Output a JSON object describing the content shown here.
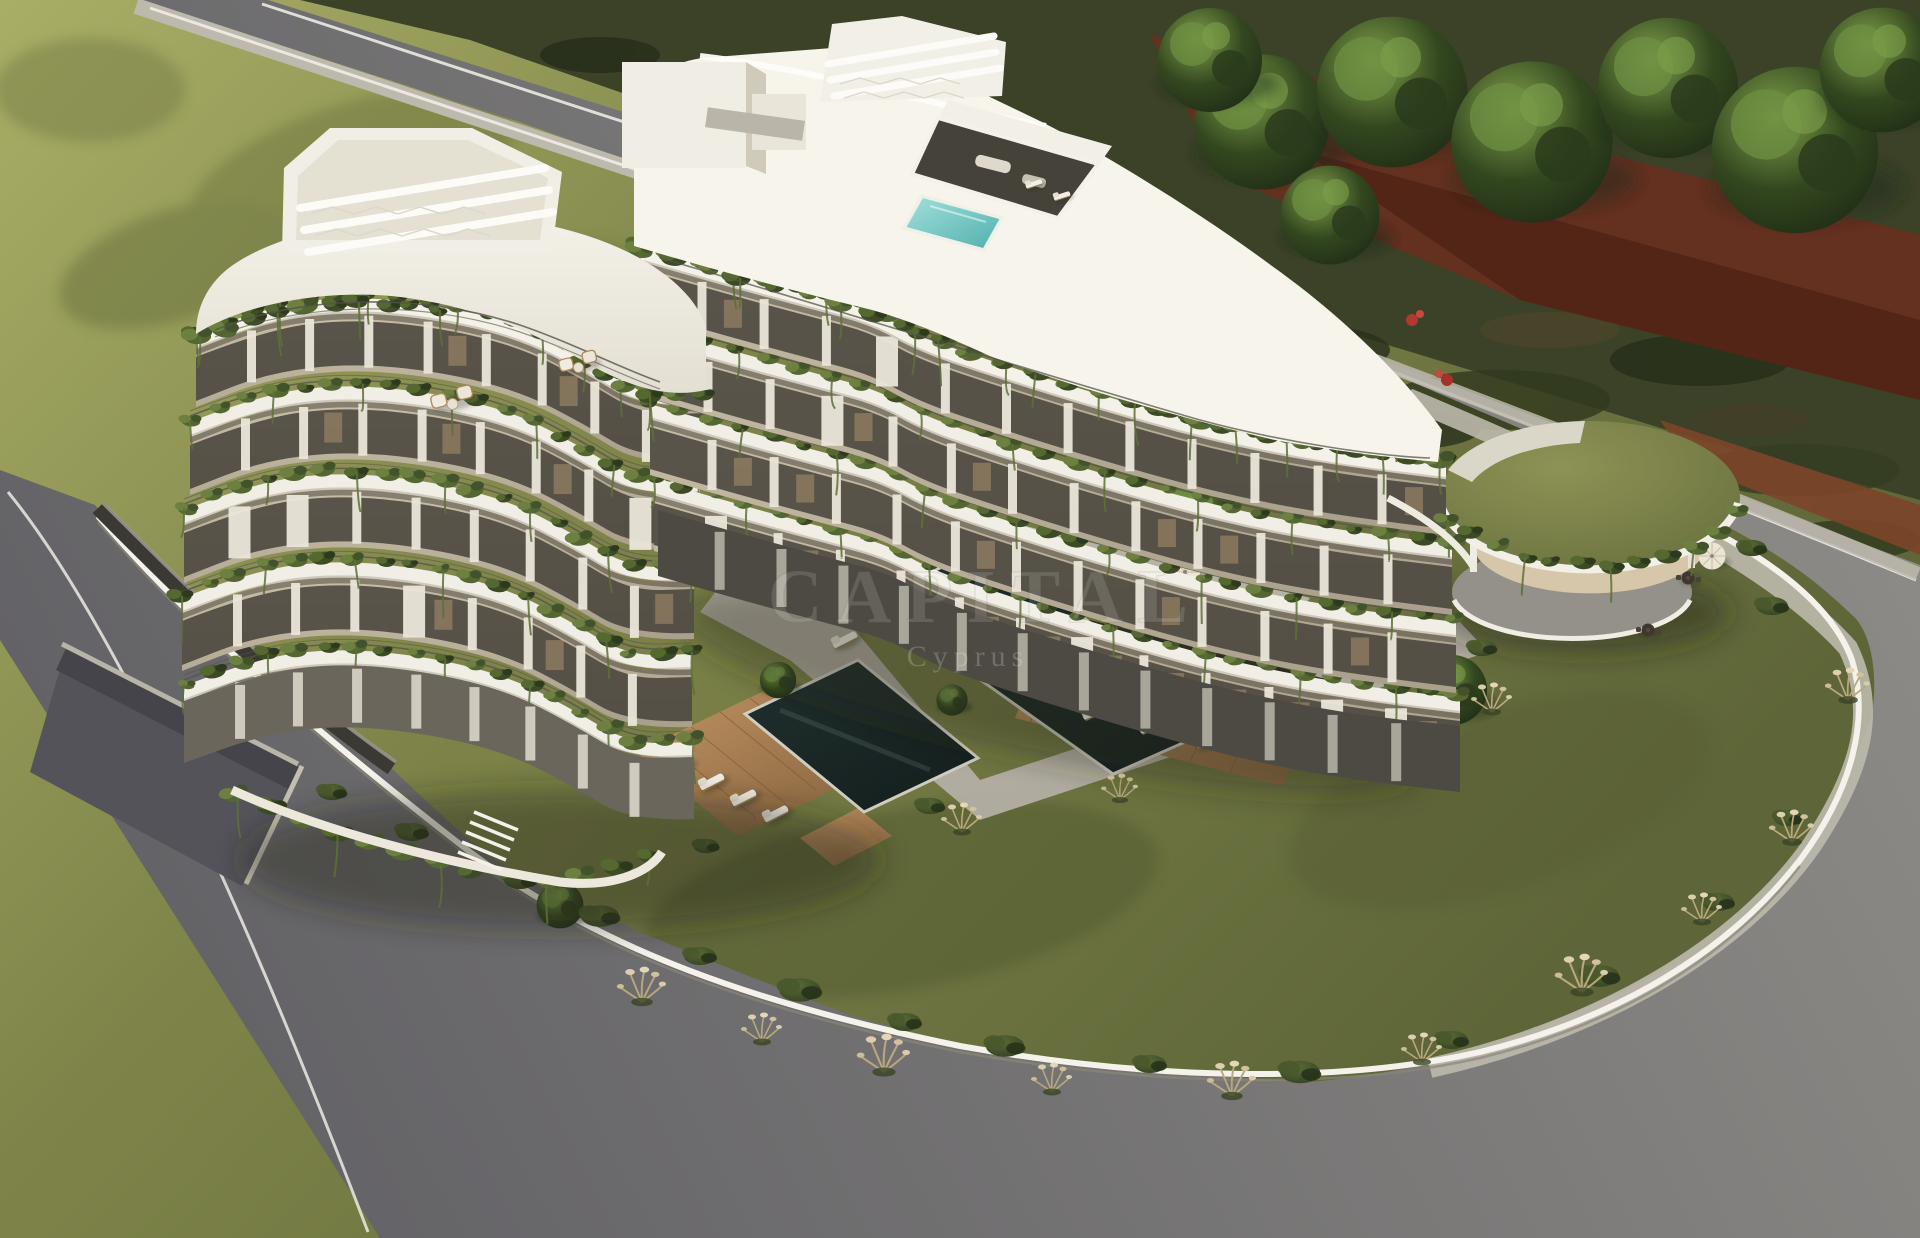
{
  "meta": {
    "title": "Aerial 3D render of a modern white residential complex with terraced hanging gardens",
    "type": "architectural-visualization",
    "view": "aerial three-quarter"
  },
  "watermark": {
    "line1": "CAPITAL",
    "line2": "Cyprus"
  },
  "palette": {
    "lawn_light": "#a9ae66",
    "lawn_mid": "#7e8449",
    "lawn_dark": "#5e6538",
    "scrub": "#3b4227",
    "scrub_dark": "#262d1b",
    "tree_light": "#7fa04a",
    "tree_dark": "#2c4020",
    "rust_wall": "#64301f",
    "dirt_strip": "#7c452a",
    "road": "#8f8d88",
    "road_dark": "#5f5e63",
    "curb_white": "#eceae4",
    "sidewalk": "#bdb9ac",
    "wall_white": "#f4f2ea",
    "retaining_wall": "#3a3933",
    "building_white": "#f4f1e9",
    "plate_shade": "#e3dfd2",
    "facade_recess": "#a99f8b",
    "glass": "#45423a",
    "interior_warm": "#c9a87b",
    "plant_green": "#5f7038",
    "plant_light": "#6d8040",
    "plant_dark": "#3c4a26",
    "wood_deck": "#a87a4e",
    "pool_water": "#131d1c",
    "rooftop_pool": "#7ccfcb",
    "stone_path": "#b3afa4",
    "pavilion_interior": "#d6c6aa",
    "flower_red": "#b03a30",
    "pampas": "#d8cbae"
  },
  "scene": {
    "building": {
      "label": "curved white apartment block, two wings",
      "left_wing_floors": 5,
      "right_wing_floors": 4,
      "features": [
        "roof pergolas",
        "rooftop plunge pool",
        "penthouse glass box",
        "hanging planted balconies"
      ]
    },
    "pools": [
      {
        "label": "main garden lap pool",
        "water": "dark reflective"
      },
      {
        "label": "secondary garden pool",
        "water": "dark reflective"
      },
      {
        "label": "rooftop plunge pool",
        "water": "turquoise"
      }
    ],
    "pavilion": {
      "label": "round green-roof garden pavilion",
      "roof": "grass",
      "interior": "lounge seating"
    },
    "roads": [
      "top boundary road",
      "right boundary road",
      "bottom-left boundary road",
      "underground parking ramp"
    ],
    "vegetation": [
      "tall trees along top-right",
      "olive trees in garden",
      "pampas grass tufts",
      "hedge bushes",
      "balcony planting"
    ]
  }
}
